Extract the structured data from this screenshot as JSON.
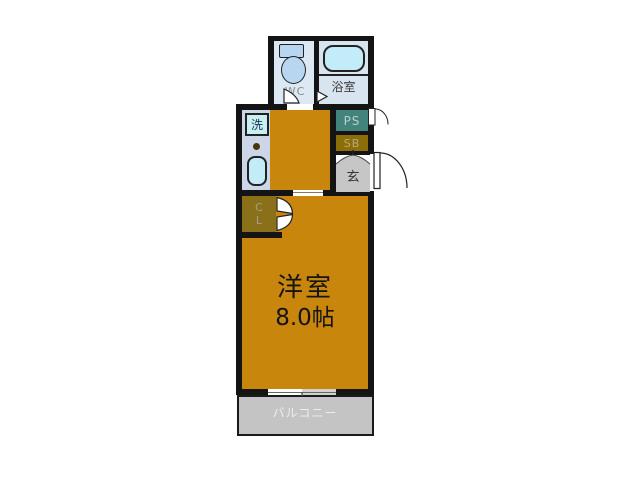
{
  "floorplan": {
    "rooms": {
      "wc": {
        "label": "WC"
      },
      "bathroom": {
        "label": "浴室"
      },
      "laundry": {
        "label": "洗"
      },
      "pipe_space": {
        "label": "PS"
      },
      "shoe_box": {
        "label": "SB"
      },
      "entrance": {
        "label": "玄"
      },
      "closet": {
        "lines": [
          "C",
          "L"
        ]
      },
      "western_room": {
        "name": "洋室",
        "size": "8.0帖"
      },
      "balcony": {
        "label": "バルコニー"
      }
    },
    "colors": {
      "wall": "#141414",
      "room_floor": "#c8860d",
      "kitchen_counter": "#ccd6e8",
      "wet_room": "#dce8f4",
      "fixture_blue": "#c4ecf8",
      "pipe_space": "#42837b",
      "storage_olive": "#8a7018",
      "entrance_gray": "#c6c6c6",
      "balcony_gray": "#c4c4c4"
    }
  }
}
